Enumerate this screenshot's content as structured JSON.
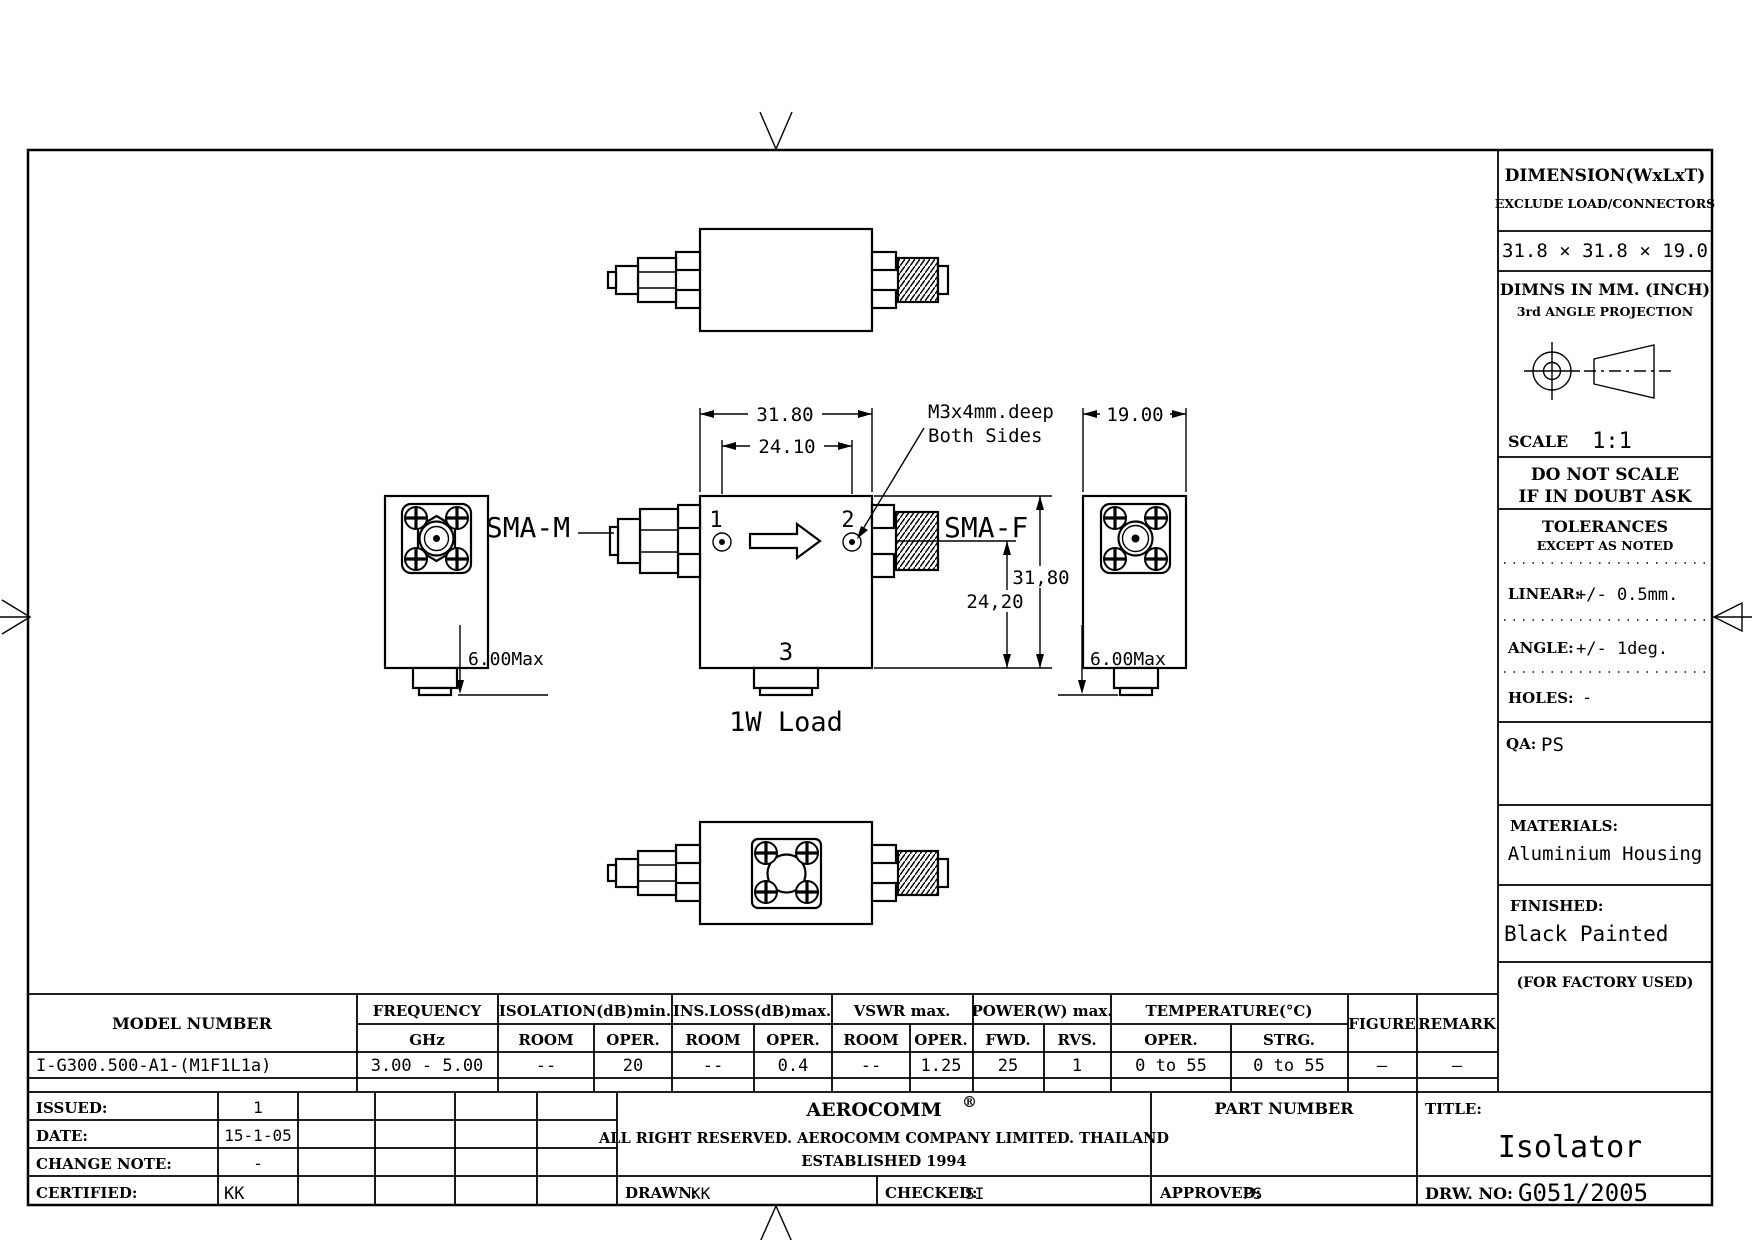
{
  "drawing": {
    "views": {
      "sma_m_label": "SMA-M",
      "sma_f_label": "SMA-F",
      "port1": "1",
      "port2": "2",
      "port3": "3",
      "load_label": "1W Load",
      "callout_line1": "M3x4mm.deep",
      "callout_line2": "Both Sides"
    },
    "dimensions": {
      "body_width": "31.80",
      "hole_spacing": "24.10",
      "body_height": "31,80",
      "port_height": "24,20",
      "side_width": "19.00",
      "tab_left": "6.00Max",
      "tab_right": "6.00Max"
    }
  },
  "info_panel": {
    "dimension_title": "DIMENSION(WxLxT)",
    "dimension_sub": "EXCLUDE LOAD/CONNECTORS",
    "dimension_value": "31.8 × 31.8 × 19.0",
    "units_line1": "DIMNS IN MM. (INCH)",
    "units_line2": "3rd ANGLE PROJECTION",
    "scale_label": "SCALE",
    "scale_value": "1:1",
    "warning_line1": "DO NOT SCALE",
    "warning_line2": "IF IN DOUBT ASK",
    "tolerances_title": "TOLERANCES",
    "tolerances_sub": "EXCEPT AS NOTED",
    "linear_label": "LINEAR:",
    "linear_value": "+/-  0.5mm.",
    "angle_label": "ANGLE:",
    "angle_value": "+/-  1deg.",
    "holes_label": "HOLES:",
    "holes_value": "-",
    "qa_label": "QA:",
    "qa_value": "PS",
    "materials_label": "MATERIALS:",
    "materials_value": "Aluminium Housing",
    "finished_label": "FINISHED:",
    "finished_value": "Black Painted",
    "factory_note": "(FOR FACTORY USED)"
  },
  "spec_table": {
    "model_header": "MODEL NUMBER",
    "freq_header1": "FREQUENCY",
    "freq_header2": "GHz",
    "groups": [
      {
        "label": "ISOLATION(dB)min.",
        "sub1": "ROOM",
        "sub2": "OPER."
      },
      {
        "label": "INS.LOSS(dB)max.",
        "sub1": "ROOM",
        "sub2": "OPER."
      },
      {
        "label": "VSWR  max.",
        "sub1": "ROOM",
        "sub2": "OPER."
      },
      {
        "label": "POWER(W)  max.",
        "sub1": "FWD.",
        "sub2": "RVS."
      },
      {
        "label": "TEMPERATURE(°C)",
        "sub1": "OPER.",
        "sub2": "STRG."
      }
    ],
    "figure_header": "FIGURE",
    "remark_header": "REMARK",
    "row": {
      "model": "I-G300.500-A1-(M1F1L1a)",
      "freq": "3.00 - 5.00",
      "iso_room": "--",
      "iso_oper": "20",
      "ins_room": "--",
      "ins_oper": "0.4",
      "vswr_room": "--",
      "vswr_oper": "1.25",
      "pwr_fwd": "25",
      "pwr_rvs": "1",
      "temp_oper": "0 to 55",
      "temp_strg": "0 to 55",
      "figure": "—",
      "remark": "—"
    }
  },
  "title_block": {
    "issued_label": "ISSUED:",
    "issued_value": "1",
    "date_label": "DATE:",
    "date_value": "15-1-05",
    "change_label": "CHANGE  NOTE:",
    "change_value": "-",
    "certified_label": "CERTIFIED:",
    "certified_value": "KK",
    "company": "AEROCOMM",
    "registered": "®",
    "rights": "ALL RIGHT RESERVED.  AEROCOMM COMPANY LIMITED.  THAILAND",
    "established": "ESTABLISHED 1994",
    "drawn_label": "DRAWN:",
    "drawn_value": "KK",
    "checked_label": "CHECKED:",
    "checked_value": "SI",
    "part_number_label": "PART  NUMBER",
    "approved_label": "APPROVED:",
    "approved_value": "PS",
    "title_label": "TITLE:",
    "title_value": "Isolator",
    "drw_label": "DRW.  NO:",
    "drw_value": "G051/2005"
  }
}
